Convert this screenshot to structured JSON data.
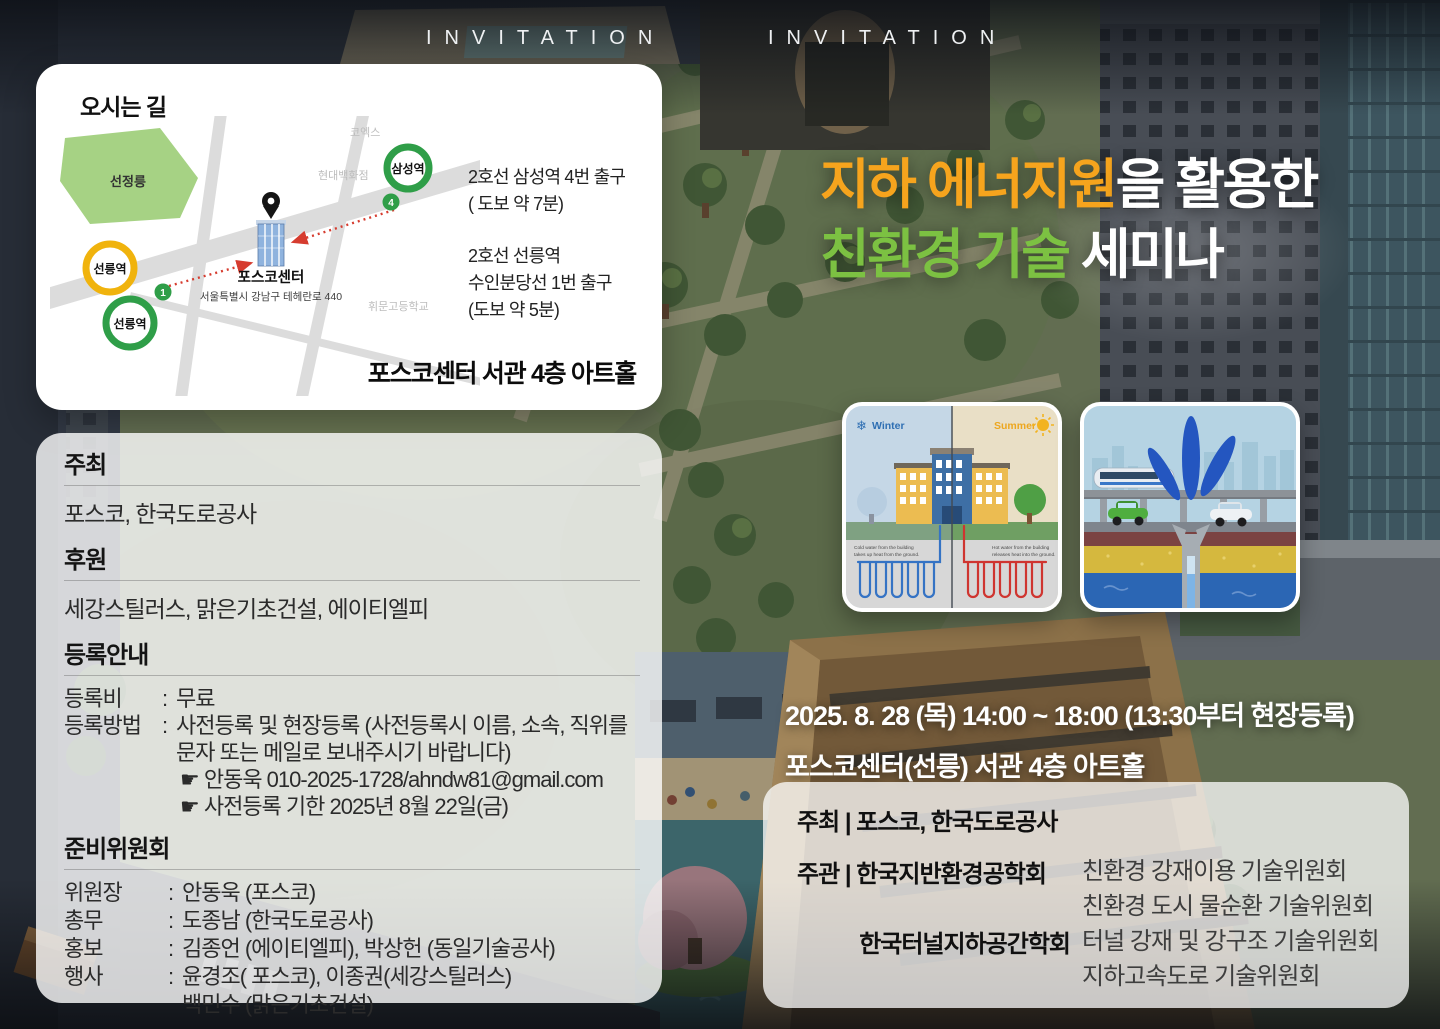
{
  "header": {
    "invitation_left": "INVITATION",
    "invitation_right": "INVITATION"
  },
  "map_card": {
    "title": "오시는 길",
    "park_label": "선정릉",
    "poi_coex": "코엑스",
    "poi_hyundai": "현대백화점",
    "poi_whimoon": "휘문고등학교",
    "station_samseong": "삼성역",
    "station_seolleung_yellow": "선릉역",
    "station_seolleung_green": "선릉역",
    "exit_badge_4": "4",
    "exit_badge_1": "1",
    "venue_name": "포스코센터",
    "venue_address": "서울특별시 강남구 테헤란로 440",
    "direction1_line1": "2호선 삼성역 4번 출구",
    "direction1_line2": "( 도보 약 7분)",
    "direction2_line1": "2호선 선릉역",
    "direction2_line2": "수인분당선 1번 출구",
    "direction2_line3": "(도보 약 5분)",
    "hall_label": "포스코센터 서관 4층 아트홀"
  },
  "title": {
    "line1_accent": "지하 에너지원",
    "line1_rest": "을 활용한",
    "line2_accent": "친환경 기술",
    "line2_rest": " 세미나"
  },
  "diagram_winter_summer": {
    "winter_label": "Winter",
    "summer_label": "Summer",
    "cold_caption_line1": "Cold water from the building",
    "cold_caption_line2": "takes up heat from the ground.",
    "hot_caption_line1": "Hot water from the building",
    "hot_caption_line2": "releases heat into the ground."
  },
  "sections": {
    "host_heading": "주최",
    "host_body": "포스코, 한국도로공사",
    "sponsor_heading": "후원",
    "sponsor_body": "세강스틸러스, 맑은기초건설, 에이티엘피"
  },
  "registration": {
    "heading": "등록안내",
    "colon": ":",
    "fee_label": "등록비",
    "fee_value": "무료",
    "method_label": "등록방법",
    "method_line1": "사전등록 및 현장등록 (사전등록시 이름, 소속, 직위를",
    "method_line2": "문자 또는 메일로 보내주시기 바랍니다)",
    "contact_line": "☛ 안동욱   010-2025-1728/ahndw81@gmail.com",
    "deadline_line": "☛ 사전등록 기한   2025년 8월 22일(금)"
  },
  "committee": {
    "heading": "준비위원회",
    "colon": ":",
    "rows": [
      {
        "role": "위원장",
        "names": "안동욱 (포스코)"
      },
      {
        "role": "총무",
        "names": "도종남 (한국도로공사)"
      },
      {
        "role": "홍보",
        "names": "김종언 (에이티엘피), 박상헌 (동일기술공사)"
      },
      {
        "role": "행사",
        "names": "윤경조( 포스코), 이종권(세강스틸러스)",
        "names_line2": "백민수 (맑은기초건설)"
      }
    ]
  },
  "event": {
    "datetime_line": "2025. 8. 28 (목)  14:00 ~ 18:00  (13:30부터 현장등록)",
    "venue_line": "포스코센터(선릉) 서관 4층 아트홀"
  },
  "hosting": {
    "host_label": "주최",
    "pipe": "|",
    "host_value": "포스코, 한국도로공사",
    "organizer_label": "주관",
    "org1_name": "한국지반환경공학회",
    "org1_item1": "친환경 강재이용 기술위원회",
    "org1_item2": "친환경 도시 물순환 기술위원회",
    "org2_name": "한국터널지하공간학회",
    "org2_item1": "터널 강재 및 강구조 기술위원회",
    "org2_item2": "지하고속도로 기술위원회"
  },
  "colors": {
    "title_orange": "#F6A41D",
    "title_green": "#7CC142",
    "station_green": "#2F9E48",
    "station_yellow": "#F0B30D",
    "route_red": "#D63C2F",
    "winter_blue": "#2F6FB3",
    "summer_orange": "#EDA71F"
  }
}
